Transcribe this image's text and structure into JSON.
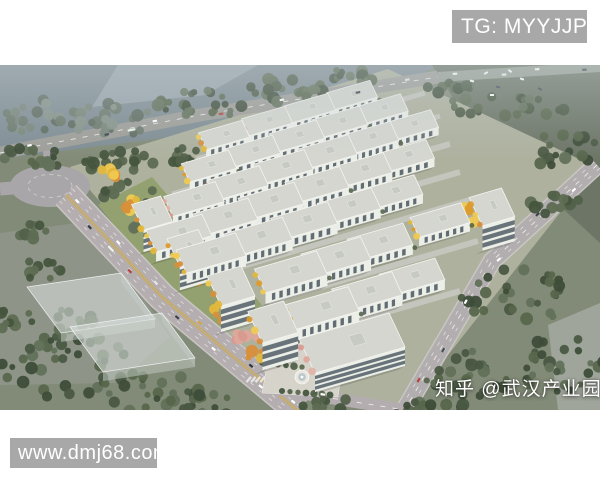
{
  "watermarks": {
    "telegram": {
      "label": "TG: MYYJJPP",
      "bg": "#a8a8a8",
      "color": "#ffffff"
    },
    "website": {
      "label": "www.dmj68.com",
      "bg": "#a8a8a8",
      "color": "#ffffff"
    },
    "zhihu": {
      "label": "知乎 @武汉产业园",
      "color": "#ffffff"
    }
  },
  "scene": {
    "colors": {
      "base": "#828b77",
      "campus": "#aeb19e",
      "roofEdge": "#f4f5f1",
      "roof": "#d4d6cf",
      "facade": "#eceee8",
      "side": "#c1c4bd",
      "window": "#525e66",
      "alley": "#c6c8c0",
      "paving": "#d6d3ca",
      "yellowLine": "#d2ab39",
      "marking": "#f2f2ef"
    },
    "palettes": {
      "forest": [
        "#3e4d39",
        "#4a5943",
        "#57664c",
        "#62715a"
      ],
      "haze": [
        "#5e6c60",
        "#6b796c",
        "#78867a",
        "#86948a"
      ],
      "road": [
        "#46553e",
        "#52614a",
        "#5d6c52"
      ],
      "autumn": [
        "#e3b83c",
        "#dd9b2e",
        "#efc952",
        "#d78f3a"
      ],
      "pinkp": [
        "#dfa89c",
        "#e2b3a6",
        "#d89a8f"
      ]
    },
    "fields": [
      {
        "name": "haze-field-northwest",
        "pts": [
          [
            0,
            0
          ],
          [
            440,
            0
          ],
          [
            352,
            42
          ],
          [
            170,
            72
          ],
          [
            0,
            94
          ]
        ],
        "fill": "#7f8d94"
      },
      {
        "name": "haze-field-light-patch",
        "pts": [
          [
            118,
            0
          ],
          [
            258,
            0
          ],
          [
            205,
            30
          ],
          [
            92,
            42
          ]
        ],
        "fill": "#9daab0",
        "opacity": 0.8
      },
      {
        "name": "farm-field-northeast",
        "pts": [
          [
            432,
            0
          ],
          [
            600,
            0
          ],
          [
            600,
            178
          ],
          [
            468,
            56
          ]
        ],
        "fill": "#6c7566"
      },
      {
        "name": "campus-ground",
        "pts": [
          [
            70,
            102
          ],
          [
            388,
            4
          ],
          [
            596,
            102
          ],
          [
            404,
            346
          ],
          [
            262,
            324
          ]
        ],
        "fill": "#aeb19e"
      },
      {
        "name": "west-pad",
        "pts": [
          [
            0,
            168
          ],
          [
            92,
            156
          ],
          [
            170,
            272
          ],
          [
            118,
            318
          ],
          [
            0,
            320
          ]
        ],
        "fill": "#8e9487"
      },
      {
        "name": "southeast-pad",
        "pts": [
          [
            548,
            260
          ],
          [
            600,
            238
          ],
          [
            600,
            345
          ],
          [
            558,
            345
          ]
        ],
        "fill": "#9fa59a"
      },
      {
        "name": "park-lawn",
        "pts": [
          [
            98,
            140
          ],
          [
            152,
            112
          ],
          [
            262,
            240
          ],
          [
            210,
            278
          ]
        ],
        "fill": "#93a171"
      }
    ],
    "roundabout": {
      "cx": 50,
      "cy": 121,
      "rx": 40,
      "ry": 21,
      "fill": "#a9a6a9"
    },
    "roads": [
      {
        "name": "west-stub-road",
        "pts": [
          [
            0,
            124
          ],
          [
            26,
            122
          ]
        ],
        "w": 13,
        "color": "#a9a6a9"
      },
      {
        "name": "north-connector-road",
        "pts": [
          [
            47,
            80
          ],
          [
            49,
            106
          ]
        ],
        "w": 9,
        "color": "#a9a6a9"
      },
      {
        "name": "top-road",
        "pts": [
          [
            0,
            88
          ],
          [
            200,
            50
          ],
          [
            438,
            12
          ]
        ],
        "w": 13,
        "color": "#9e9e99",
        "center": "dash",
        "cars": {
          "n": 7,
          "lane": 2.6,
          "bus": 0.3,
          "palette": [
            "#ffffff",
            "#3a414b",
            "#ffffff",
            "#b5443c",
            "#ffffff",
            "#39404a",
            "#e8e8e8"
          ]
        }
      },
      {
        "name": "north-highway",
        "pts": [
          [
            438,
            12
          ],
          [
            600,
            2
          ]
        ],
        "w": 10,
        "color": "#98a095",
        "cars": {
          "n": 4,
          "lane": 2.2,
          "palette": [
            "#ffffff",
            "#f2f2f2",
            "#ffffff",
            "#404650"
          ]
        }
      },
      {
        "name": "main-avenue",
        "pts": [
          [
            66,
            130
          ],
          [
            162,
            232
          ],
          [
            298,
            346
          ]
        ],
        "w": 26,
        "color": "#b5aeb1",
        "curb": true,
        "center": "double-yellow",
        "sideDash": [
          4.4,
          8.8
        ],
        "cars": {
          "n": 11,
          "lane": 6,
          "bus": 0.22,
          "palette": [
            "#ffffff",
            "#353c46",
            "#ffffff",
            "#b5443c",
            "#e8e8e6",
            "#3c434d",
            "#d9a43c",
            "#ffffff",
            "#2f3640",
            "#ffffff",
            "#ffffff"
          ]
        }
      },
      {
        "name": "east-road",
        "pts": [
          [
            597,
            100
          ],
          [
            492,
            196
          ],
          [
            404,
            346
          ]
        ],
        "w": 16,
        "color": "#b2adaf",
        "curb": true,
        "center": "dash",
        "sideDash": [
          4.2
        ],
        "cars": {
          "n": 6,
          "lane": 3.4,
          "palette": [
            "#ffffff",
            "#3c434d",
            "#ffffff",
            "#ffffff",
            "#474e58",
            "#b5443c"
          ]
        }
      },
      {
        "name": "south-branch-road",
        "pts": [
          [
            262,
            322
          ],
          [
            436,
            350
          ]
        ],
        "w": 12,
        "color": "#b4adb0",
        "center": "dash",
        "cars": {
          "n": 2,
          "lane": 2.6,
          "palette": [
            "#ffffff",
            "#3c434d"
          ]
        }
      }
    ],
    "alleys": [
      {
        "pts": [
          [
            196,
            94
          ],
          [
            425,
            28
          ]
        ],
        "w": 5
      },
      {
        "pts": [
          [
            172,
            129
          ],
          [
            440,
            51
          ]
        ],
        "w": 5
      },
      {
        "pts": [
          [
            175,
            158
          ],
          [
            450,
            79
          ]
        ],
        "w": 6
      },
      {
        "pts": [
          [
            186,
            186
          ],
          [
            460,
            107
          ]
        ],
        "w": 6
      },
      {
        "pts": [
          [
            208,
            211
          ],
          [
            470,
            135
          ]
        ],
        "w": 6
      },
      {
        "pts": [
          [
            268,
            237
          ],
          [
            478,
            176
          ]
        ],
        "w": 6
      },
      {
        "pts": [
          [
            300,
            272
          ],
          [
            460,
            226
          ]
        ],
        "w": 6
      }
    ],
    "treeClusters": [
      {
        "x": 30,
        "y": 50,
        "rx": 35,
        "ry": 18,
        "n": 20,
        "p": "haze"
      },
      {
        "x": 110,
        "y": 55,
        "rx": 45,
        "ry": 17,
        "n": 24,
        "p": "haze"
      },
      {
        "x": 200,
        "y": 40,
        "rx": 45,
        "ry": 15,
        "n": 24,
        "p": "forest"
      },
      {
        "x": 285,
        "y": 25,
        "rx": 40,
        "ry": 12,
        "n": 20,
        "p": "forest"
      },
      {
        "x": 350,
        "y": 12,
        "rx": 30,
        "ry": 10,
        "n": 14,
        "p": "forest"
      },
      {
        "x": 35,
        "y": 92,
        "rx": 35,
        "ry": 12,
        "n": 18,
        "p": "forest"
      },
      {
        "x": 115,
        "y": 96,
        "rx": 40,
        "ry": 12,
        "n": 20,
        "p": "road"
      },
      {
        "x": 195,
        "y": 92,
        "rx": 30,
        "ry": 10,
        "n": 14,
        "p": "road"
      },
      {
        "x": 505,
        "y": 42,
        "rx": 65,
        "ry": 11,
        "n": 22,
        "p": "forest"
      },
      {
        "x": 560,
        "y": 85,
        "rx": 40,
        "ry": 18,
        "n": 16,
        "p": "forest"
      },
      {
        "x": 455,
        "y": 22,
        "rx": 30,
        "ry": 8,
        "n": 10,
        "p": "forest"
      },
      {
        "x": 560,
        "y": 140,
        "rx": 30,
        "ry": 12,
        "n": 12,
        "p": "road"
      },
      {
        "x": 520,
        "y": 230,
        "rx": 60,
        "ry": 28,
        "n": 30,
        "p": "forest"
      },
      {
        "x": 560,
        "y": 300,
        "rx": 45,
        "ry": 28,
        "n": 26,
        "p": "forest"
      },
      {
        "x": 470,
        "y": 310,
        "rx": 45,
        "ry": 24,
        "n": 24,
        "p": "forest"
      },
      {
        "x": 430,
        "y": 342,
        "rx": 35,
        "ry": 12,
        "n": 16,
        "p": "forest"
      },
      {
        "x": 468,
        "y": 150,
        "rx": 20,
        "ry": 8,
        "n": 8,
        "p": "autumn"
      },
      {
        "x": 60,
        "y": 300,
        "rx": 70,
        "ry": 35,
        "n": 40,
        "p": "forest"
      },
      {
        "x": 150,
        "y": 330,
        "rx": 55,
        "ry": 26,
        "n": 28,
        "p": "forest"
      },
      {
        "x": 10,
        "y": 255,
        "rx": 22,
        "ry": 14,
        "n": 12,
        "p": "road"
      },
      {
        "x": 205,
        "y": 342,
        "rx": 35,
        "ry": 14,
        "n": 16,
        "p": "forest"
      },
      {
        "x": 28,
        "y": 165,
        "rx": 18,
        "ry": 10,
        "n": 9,
        "p": "road"
      },
      {
        "x": 42,
        "y": 205,
        "rx": 20,
        "ry": 11,
        "n": 10,
        "p": "road"
      },
      {
        "x": 72,
        "y": 255,
        "rx": 24,
        "ry": 12,
        "n": 11,
        "p": "road"
      },
      {
        "x": 128,
        "y": 128,
        "rx": 26,
        "ry": 14,
        "n": 12,
        "p": "road"
      },
      {
        "x": 158,
        "y": 158,
        "rx": 28,
        "ry": 15,
        "n": 12,
        "p": "forest"
      },
      {
        "x": 190,
        "y": 195,
        "rx": 26,
        "ry": 14,
        "n": 11,
        "p": "road"
      },
      {
        "x": 112,
        "y": 108,
        "rx": 13,
        "ry": 7,
        "n": 7,
        "p": "autumn"
      },
      {
        "x": 138,
        "y": 140,
        "rx": 15,
        "ry": 8,
        "n": 8,
        "p": "autumn"
      },
      {
        "x": 170,
        "y": 176,
        "rx": 15,
        "ry": 8,
        "n": 8,
        "p": "autumn"
      },
      {
        "x": 200,
        "y": 212,
        "rx": 15,
        "ry": 8,
        "n": 8,
        "p": "autumn"
      },
      {
        "x": 228,
        "y": 248,
        "rx": 16,
        "ry": 8,
        "n": 9,
        "p": "autumn"
      },
      {
        "x": 245,
        "y": 270,
        "rx": 14,
        "ry": 7,
        "n": 7,
        "p": "pinkp"
      },
      {
        "x": 258,
        "y": 292,
        "rx": 13,
        "ry": 7,
        "n": 7,
        "p": "autumn"
      },
      {
        "x": 330,
        "y": 340,
        "rx": 28,
        "ry": 7,
        "n": 9,
        "p": "road"
      }
    ],
    "plaza": {
      "paving": [
        [
          272,
          272
        ],
        [
          348,
          262
        ],
        [
          338,
          332
        ],
        [
          262,
          328
        ]
      ],
      "fountain": {
        "cx": 302,
        "cy": 312,
        "r": 7
      },
      "treeRows": [
        {
          "x": 300,
          "y": 276,
          "rx": 26,
          "ry": 4,
          "n": 8
        },
        {
          "x": 282,
          "y": 300,
          "rx": 20,
          "ry": 4,
          "n": 6
        },
        {
          "x": 306,
          "y": 328,
          "rx": 24,
          "ry": 4,
          "n": 7
        }
      ]
    },
    "ghosts": [
      {
        "c0": [
          27,
          222
        ],
        "L": [
          94,
          -14
        ],
        "D": [
          34,
          46
        ],
        "h": 9
      },
      {
        "c0": [
          70,
          262
        ],
        "L": [
          92,
          -14
        ],
        "D": [
          33,
          45
        ],
        "h": 9
      }
    ],
    "buildings": [
      [
        224,
        70,
        0.7,
        "w"
      ],
      [
        267,
        56,
        0.7,
        "w"
      ],
      [
        310,
        43,
        0.7,
        "w"
      ],
      [
        352,
        30,
        0.7,
        "w"
      ],
      [
        209,
        101,
        0.76,
        "w"
      ],
      [
        253,
        86,
        0.76,
        "w"
      ],
      [
        297,
        71,
        0.76,
        "w"
      ],
      [
        340,
        57,
        0.76,
        "w"
      ],
      [
        382,
        44,
        0.72,
        "w"
      ],
      [
        194,
        134,
        0.83,
        "w"
      ],
      [
        238,
        118,
        0.83,
        "w"
      ],
      [
        283,
        102,
        0.83,
        "w"
      ],
      [
        327,
        87,
        0.83,
        "w"
      ],
      [
        370,
        73,
        0.79,
        "w"
      ],
      [
        412,
        60,
        0.73,
        "w"
      ],
      [
        179,
        168,
        0.9,
        "w"
      ],
      [
        225,
        152,
        0.9,
        "w"
      ],
      [
        271,
        136,
        0.9,
        "w"
      ],
      [
        317,
        120,
        0.88,
        "w"
      ],
      [
        362,
        105,
        0.83,
        "w"
      ],
      [
        406,
        91,
        0.78,
        "w"
      ],
      [
        211,
        188,
        0.96,
        "w"
      ],
      [
        258,
        172,
        0.95,
        "w"
      ],
      [
        304,
        156,
        0.92,
        "w"
      ],
      [
        349,
        141,
        0.87,
        "w"
      ],
      [
        393,
        127,
        0.82,
        "w"
      ],
      [
        440,
        155,
        0.82,
        "w"
      ],
      [
        291,
        207,
        1.0,
        "w"
      ],
      [
        336,
        192,
        0.96,
        "w"
      ],
      [
        380,
        177,
        0.9,
        "w"
      ],
      [
        322,
        243,
        1.02,
        "w"
      ],
      [
        367,
        227,
        0.97,
        "w"
      ],
      [
        412,
        212,
        0.9,
        "w"
      ],
      [
        152,
        148,
        0.85,
        "o"
      ],
      [
        189,
        183,
        0.92,
        "o"
      ],
      [
        231,
        221,
        1.0,
        "o"
      ],
      [
        273,
        257,
        1.05,
        "o"
      ],
      [
        492,
        142,
        0.95,
        "o"
      ],
      [
        352,
        278,
        1.0,
        "wo"
      ]
    ],
    "scatterCars": [
      [
        472,
        16
      ],
      [
        486,
        8
      ],
      [
        498,
        22
      ],
      [
        510,
        6
      ],
      [
        522,
        14
      ],
      [
        540,
        24
      ],
      [
        492,
        30
      ]
    ]
  }
}
